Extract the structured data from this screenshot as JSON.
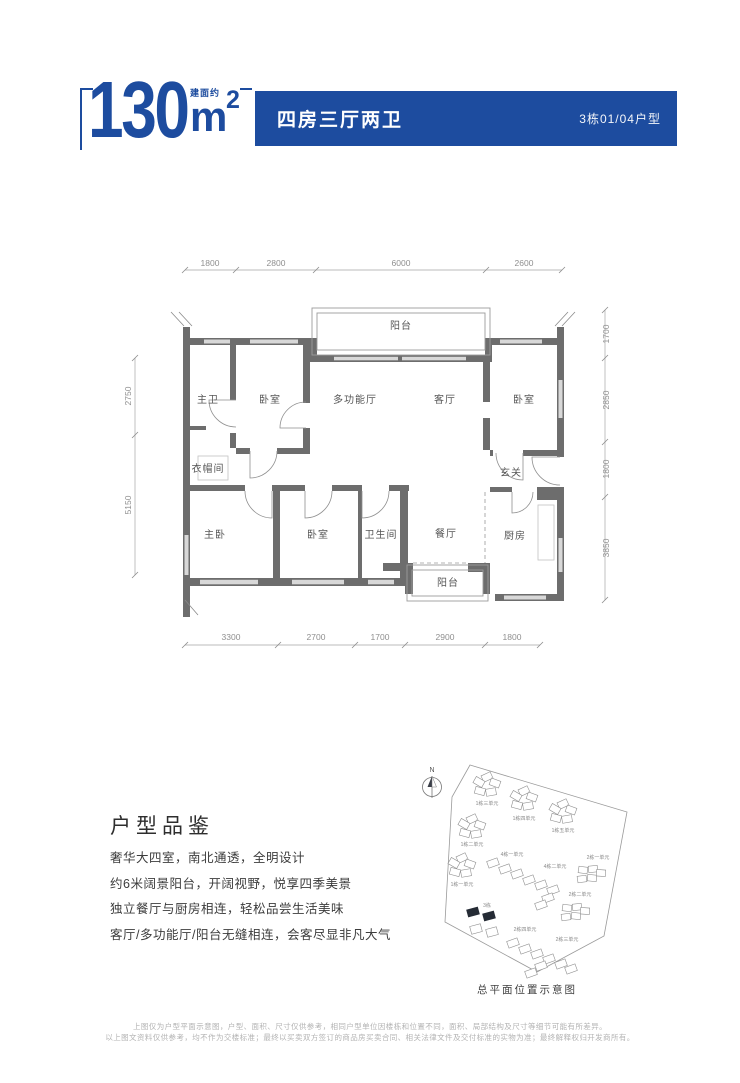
{
  "header": {
    "area_prefix": "建面约",
    "area_value": "130",
    "area_unit": "m",
    "area_sup": "2",
    "layout_title": "四房三厅两卫",
    "unit_info": "3栋01/04户型",
    "accent_color": "#1d4c9f"
  },
  "floorplan": {
    "rooms": [
      "阳台",
      "主卫",
      "卧室",
      "多功能厅",
      "客厅",
      "卧室",
      "衣帽间",
      "玄关",
      "主卧",
      "卧室",
      "卫生间",
      "餐厅",
      "厨房",
      "阳台"
    ],
    "dims": {
      "top": [
        "1800",
        "2800",
        "6000",
        "2600"
      ],
      "bottom": [
        "3300",
        "2700",
        "1700",
        "2900",
        "1800"
      ],
      "left": [
        "2750",
        "5150"
      ],
      "right": [
        "1700",
        "2850",
        "1800",
        "3850"
      ]
    }
  },
  "description": {
    "title": "户型品鉴",
    "lines": [
      "奢华大四室，南北通透，全明设计",
      "约6米阔景阳台，开阔视野，悦享四季美景",
      "独立餐厅与厨房相连，轻松品尝生活美味",
      "客厅/多功能厅/阳台无缝相连，会客尽显非凡大气"
    ]
  },
  "siteplan": {
    "compass_label": "N",
    "caption": "总平面位置示意图",
    "highlight_color": "#252b35",
    "buildings": [
      {
        "label": "1栋三单元",
        "highlighted": false
      },
      {
        "label": "1栋四单元",
        "highlighted": false
      },
      {
        "label": "1栋五单元",
        "highlighted": false
      },
      {
        "label": "1栋二单元",
        "highlighted": false
      },
      {
        "label": "4栋一单元",
        "highlighted": false
      },
      {
        "label": "4栋二单元",
        "highlighted": false
      },
      {
        "label": "1栋一单元",
        "highlighted": false
      },
      {
        "label": "2栋一单元",
        "highlighted": false
      },
      {
        "label": "2栋二单元",
        "highlighted": false
      },
      {
        "label": "3栋",
        "highlighted": true
      },
      {
        "label": "2栋四单元",
        "highlighted": false
      },
      {
        "label": "2栋三单元",
        "highlighted": false
      }
    ]
  },
  "disclaimer": {
    "lines": [
      "上图仅为户型平面示意图，户型、面积、尺寸仅供参考，相同户型单位因楼栋和位置不同，面积、局部结构及尺寸等细节可能有所差异。",
      "以上图文资料仅供参考，均不作为交楼标准；最终以买卖双方签订的商品房买卖合同、相关法律文件及交付标准的实物为准；最终解释权归开发商所有。"
    ]
  }
}
